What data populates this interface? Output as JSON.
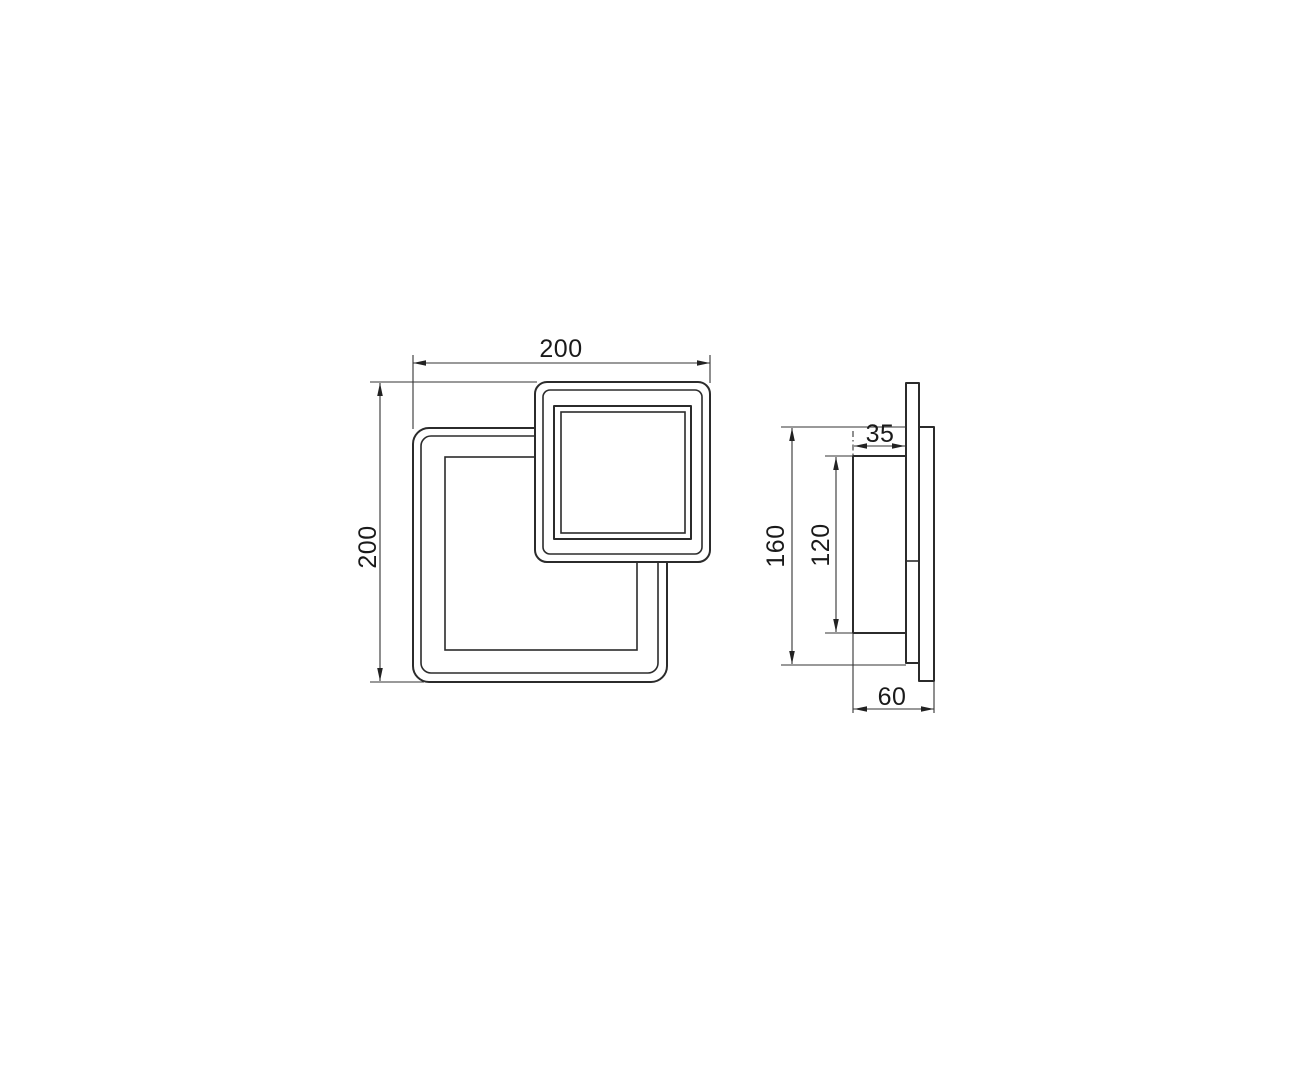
{
  "drawing": {
    "kind": "technical-dimension-drawing",
    "background_color": "#ffffff",
    "line_color": "#2b2b2b",
    "dimension_color": "#333333",
    "dimensions": {
      "front_width": "200",
      "front_height": "200",
      "side_overall_height": "160",
      "side_panel_height": "120",
      "side_panel_depth": "35",
      "side_total_depth": "60"
    }
  }
}
